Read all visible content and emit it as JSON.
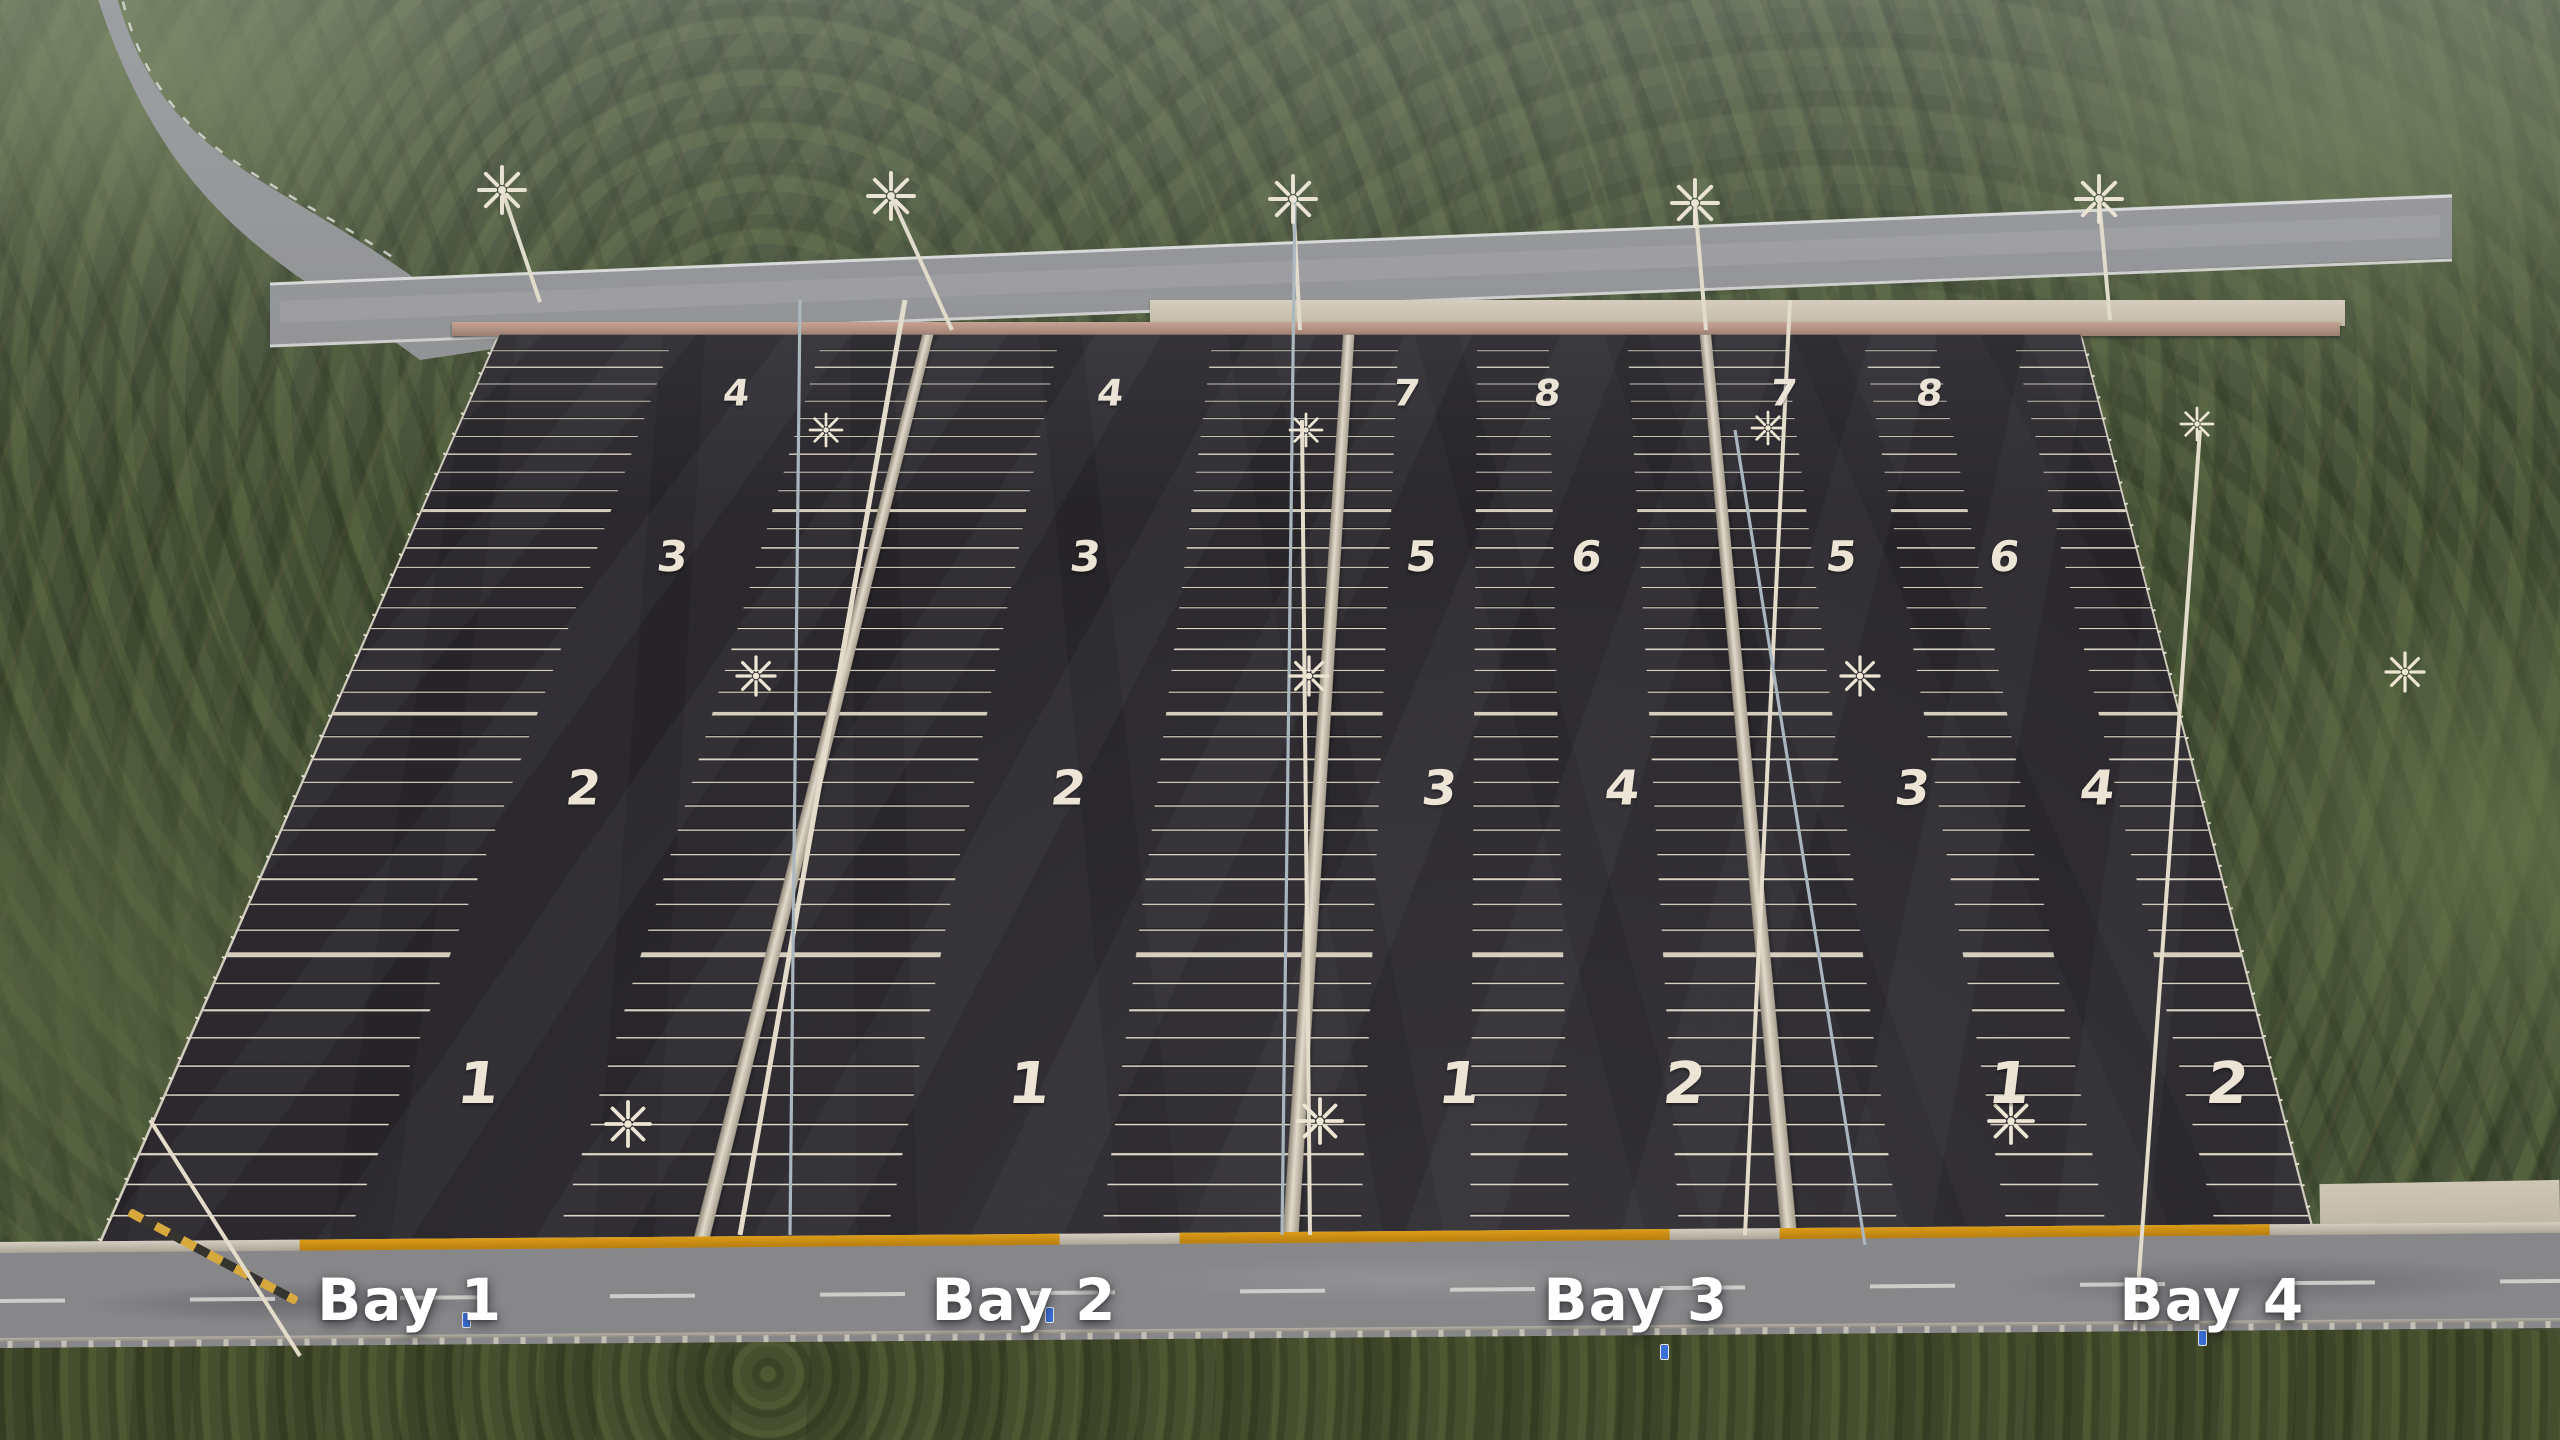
{
  "bays": [
    {
      "name": "Bay 1",
      "zones": [
        "1",
        "2",
        "3",
        "4"
      ]
    },
    {
      "name": "Bay 2",
      "zones": [
        "1",
        "2",
        "3",
        "4"
      ]
    },
    {
      "name": "Bay 3",
      "zones": [
        "1",
        "2",
        "3",
        "4",
        "5",
        "6",
        "7",
        "8"
      ]
    },
    {
      "name": "Bay 4",
      "zones": [
        "1",
        "2",
        "3",
        "4",
        "5",
        "6",
        "7",
        "8"
      ]
    }
  ],
  "icons": {
    "street_light": "eight-arm-lamp-cluster",
    "road_sign": "blue-rectangular-sign",
    "barrier": "yellow-black-striped-barrier"
  },
  "colors": {
    "asphalt": "#2b292e",
    "stall_line": "#dcd5c5",
    "road": "#87878a",
    "grass": "#454e2d",
    "forest": "#465238",
    "curb_orange": "#dc9c17",
    "bay_label_text": "#ffffff",
    "zone_number_text": "#ece5d6"
  }
}
